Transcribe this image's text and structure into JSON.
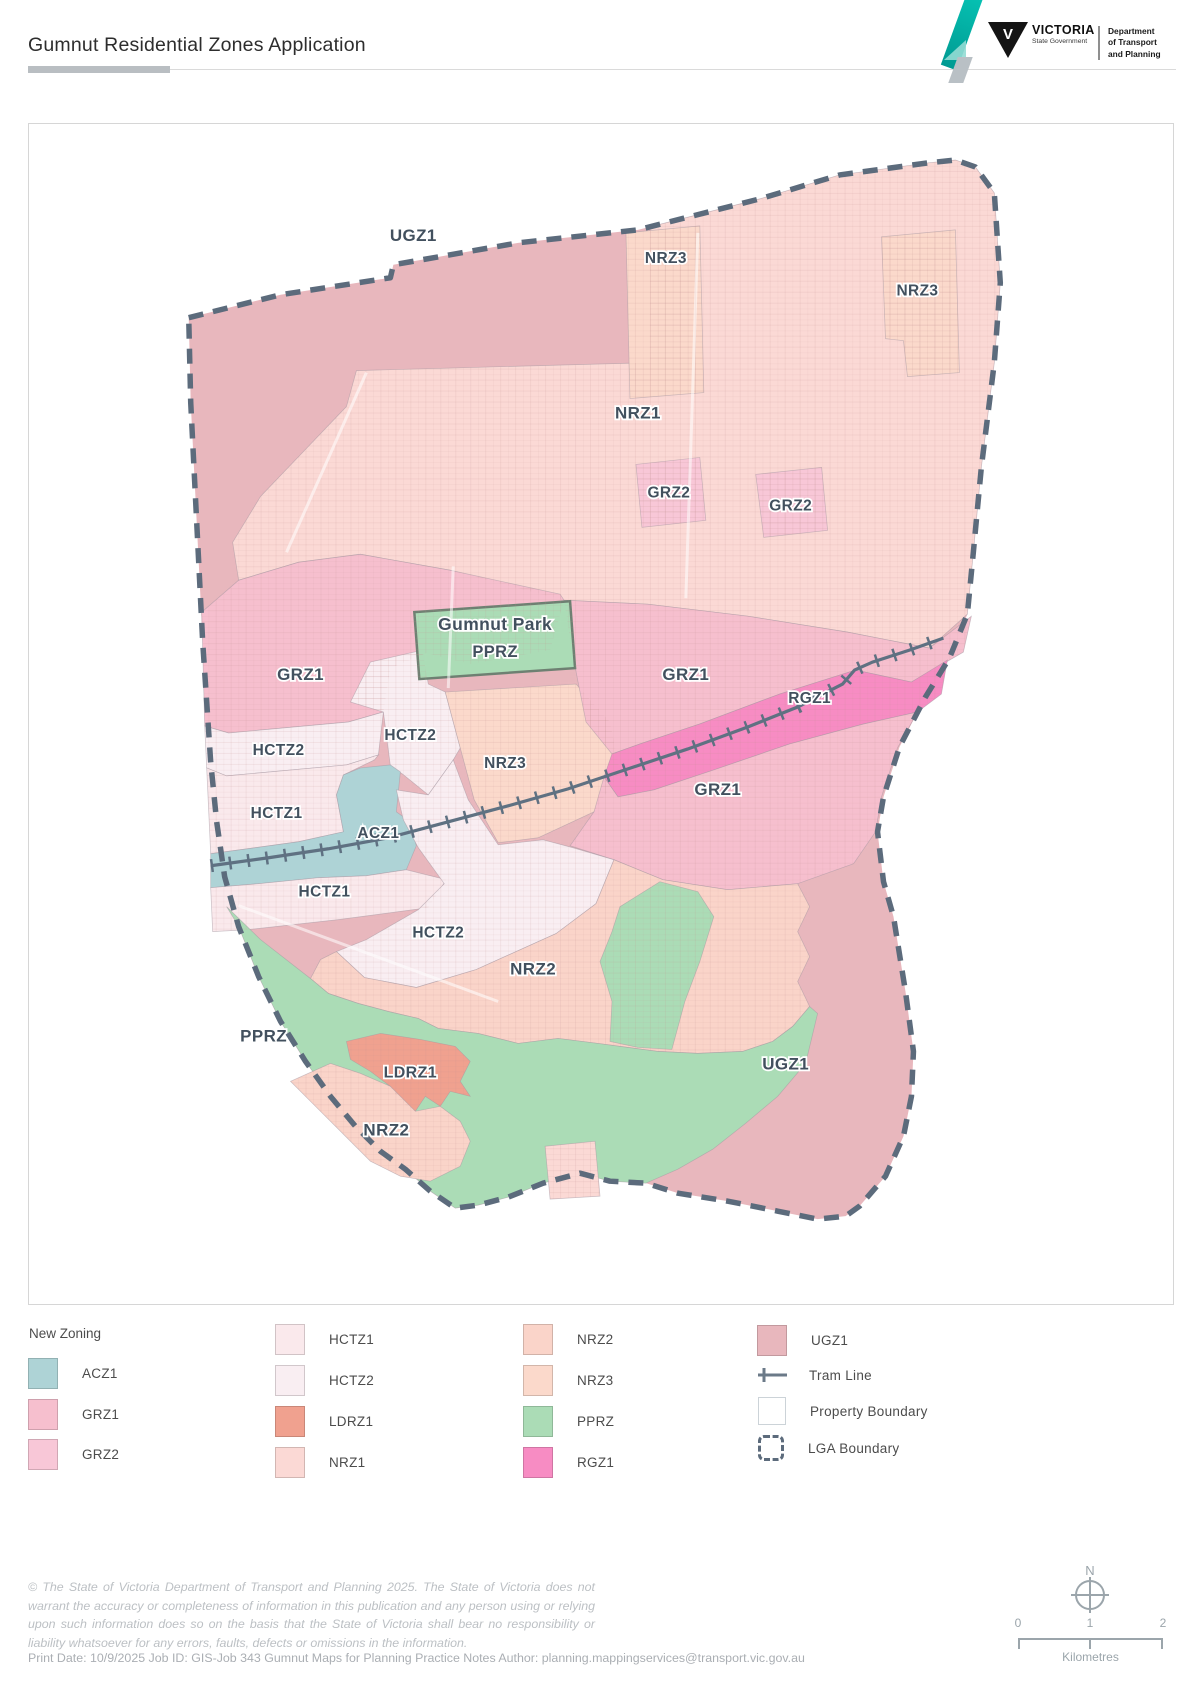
{
  "header": {
    "title": "Gumnut Residential Zones Application",
    "logo": {
      "brand": "VICTORIA",
      "brand_sub": "State Government",
      "emblem_letter": "V",
      "department": [
        "Department",
        "of Transport",
        "and Planning"
      ]
    }
  },
  "zones": {
    "ACZ1": "#aed3d6",
    "GRZ1": "#f6bfce",
    "GRZ2": "#f8c7d7",
    "HCTZ1": "#fae9ec",
    "HCTZ2": "#f9eef2",
    "LDRZ1": "#f0a18f",
    "NRZ1": "#fbd9d5",
    "NRZ2": "#fad4c9",
    "NRZ3": "#fbd9cb",
    "PPRZ": "#abdcb6",
    "RGZ1": "#f78cc3",
    "UGZ1": "#e8b7bd"
  },
  "line_colors": {
    "lga_boundary": "#5c6b7c",
    "tram_line": "#5f7182"
  },
  "map": {
    "labels": [
      {
        "text": "UGZ1",
        "x": 415,
        "y": 240,
        "s": 17
      },
      {
        "text": "NRZ3",
        "x": 668,
        "y": 262,
        "s": 15.5
      },
      {
        "text": "NRZ3",
        "x": 920,
        "y": 295,
        "s": 15.5
      },
      {
        "text": "NRZ1",
        "x": 640,
        "y": 418,
        "s": 17
      },
      {
        "text": "GRZ2",
        "x": 671,
        "y": 497,
        "s": 15.5
      },
      {
        "text": "GRZ2",
        "x": 793,
        "y": 510,
        "s": 15.5
      },
      {
        "text": "Gumnut Park",
        "x": 497,
        "y": 630,
        "s": 17.5
      },
      {
        "text": "PPRZ",
        "x": 497,
        "y": 657,
        "s": 16.5
      },
      {
        "text": "GRZ1",
        "x": 302,
        "y": 680,
        "s": 17
      },
      {
        "text": "GRZ1",
        "x": 688,
        "y": 680,
        "s": 17
      },
      {
        "text": "RGZ1",
        "x": 812,
        "y": 703,
        "s": 15.5
      },
      {
        "text": "HCTZ2",
        "x": 412,
        "y": 740,
        "s": 15.5
      },
      {
        "text": "NRZ3",
        "x": 507,
        "y": 768,
        "s": 15.5
      },
      {
        "text": "HCTZ2",
        "x": 280,
        "y": 755,
        "s": 15.5
      },
      {
        "text": "HCTZ1",
        "x": 278,
        "y": 818,
        "s": 15.5
      },
      {
        "text": "ACZ1",
        "x": 380,
        "y": 838,
        "s": 15.5
      },
      {
        "text": "GRZ1",
        "x": 720,
        "y": 795,
        "s": 17
      },
      {
        "text": "HCTZ1",
        "x": 326,
        "y": 897,
        "s": 15.5
      },
      {
        "text": "HCTZ2",
        "x": 440,
        "y": 938,
        "s": 15.5
      },
      {
        "text": "NRZ2",
        "x": 535,
        "y": 975,
        "s": 17
      },
      {
        "text": "PPRZ",
        "x": 265,
        "y": 1042,
        "s": 17
      },
      {
        "text": "LDRZ1",
        "x": 412,
        "y": 1078,
        "s": 16
      },
      {
        "text": "UGZ1",
        "x": 788,
        "y": 1070,
        "s": 17
      },
      {
        "text": "NRZ2",
        "x": 388,
        "y": 1136,
        "s": 17
      }
    ]
  },
  "legend": {
    "title": "New Zoning",
    "col1": [
      {
        "code": "ACZ1"
      },
      {
        "code": "GRZ1"
      },
      {
        "code": "GRZ2"
      }
    ],
    "col2": [
      {
        "code": "HCTZ1"
      },
      {
        "code": "HCTZ2"
      },
      {
        "code": "LDRZ1"
      },
      {
        "code": "NRZ1"
      }
    ],
    "col3": [
      {
        "code": "NRZ2"
      },
      {
        "code": "NRZ3"
      },
      {
        "code": "PPRZ"
      },
      {
        "code": "RGZ1"
      }
    ],
    "col4_zone": {
      "code": "UGZ1"
    },
    "tram_label": "Tram Line",
    "property_label": "Property Boundary",
    "lga_label": "LGA Boundary"
  },
  "annotations": {
    "north_label": "N",
    "scale_ticks": [
      "0",
      "1",
      "2"
    ],
    "scale_unit": "Kilometres"
  },
  "footer": {
    "disclaimer": "© The State of Victoria Department of Transport and Planning 2025. The State of Victoria does not warrant the accuracy or completeness of information in this publication and any person using or relying upon such information does so on the basis that the State of Victoria shall bear no responsibility or liability whatsoever for any errors, faults, defects or omissions in the information.",
    "print_line": "Print Date: 10/9/2025  Job ID: GIS-Job 343 Gumnut Maps for Planning Practice Notes   Author: planning.mappingservices@transport.vic.gov.au"
  }
}
